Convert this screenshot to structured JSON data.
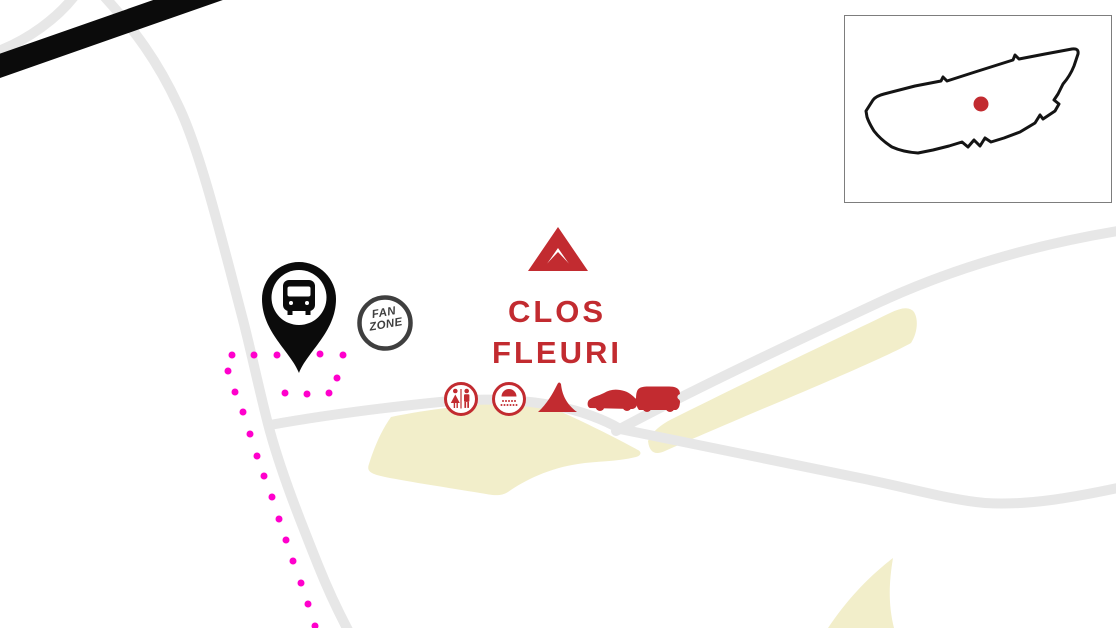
{
  "site": {
    "name_line1": "CLOS",
    "name_line2": "FLEURI"
  },
  "fan_zone_badge": {
    "line1": "FAN",
    "line2": "ZONE"
  },
  "markers": {
    "bus_stop_pin": "bus-icon",
    "campsite_logo": "tent-chevron-icon",
    "amenities": [
      "toilets-icon",
      "shower-icon",
      "tent-icon",
      "car-icon",
      "camper-van-icon"
    ],
    "inset_location": "red-dot"
  },
  "colors": {
    "accent_red": "#c22b30",
    "road_gray": "#e7e7e7",
    "field_beige": "#f2eeca",
    "route_magenta": "#ff00cc",
    "pin_black": "#0b0b0b",
    "badge_gray": "#3f3f3f",
    "inset_border": "#7d7d7d",
    "outline_black": "#141414"
  }
}
